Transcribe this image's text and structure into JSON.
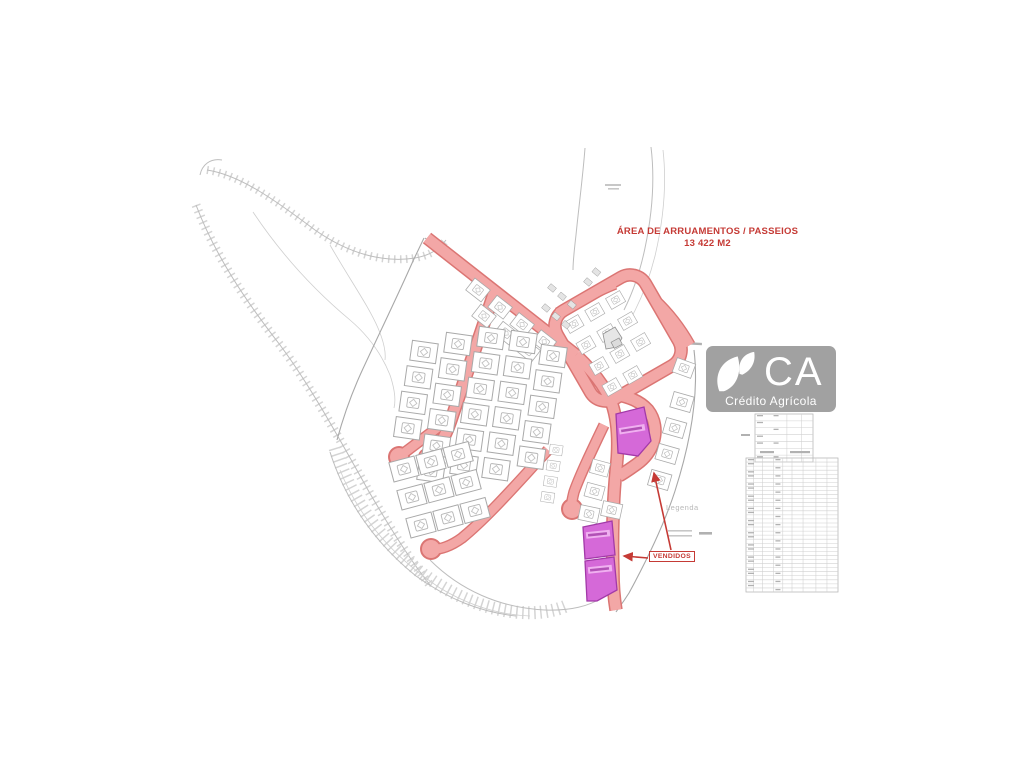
{
  "annotations": {
    "area_title_line1": "ÁREA DE ARRUAMENTOS / PASSEIOS",
    "area_title_line2": "13 422 M2",
    "vendidos_label": "VENDIDOS",
    "legend_title": "Legenda"
  },
  "logo": {
    "initials": "CA",
    "name": "Crédito Agrícola",
    "icon": "leaf-icon"
  },
  "colors": {
    "road_fill": "#f3a7a6",
    "road_edge": "#db7573",
    "sold_lot_fill": "#d569d8",
    "sold_lot_edge": "#a23aa8",
    "annotation_red": "#c53a35",
    "drawing_gray": "#b5b5b5",
    "logo_bg": "#9a9a9a",
    "logo_fg": "#ffffff"
  }
}
